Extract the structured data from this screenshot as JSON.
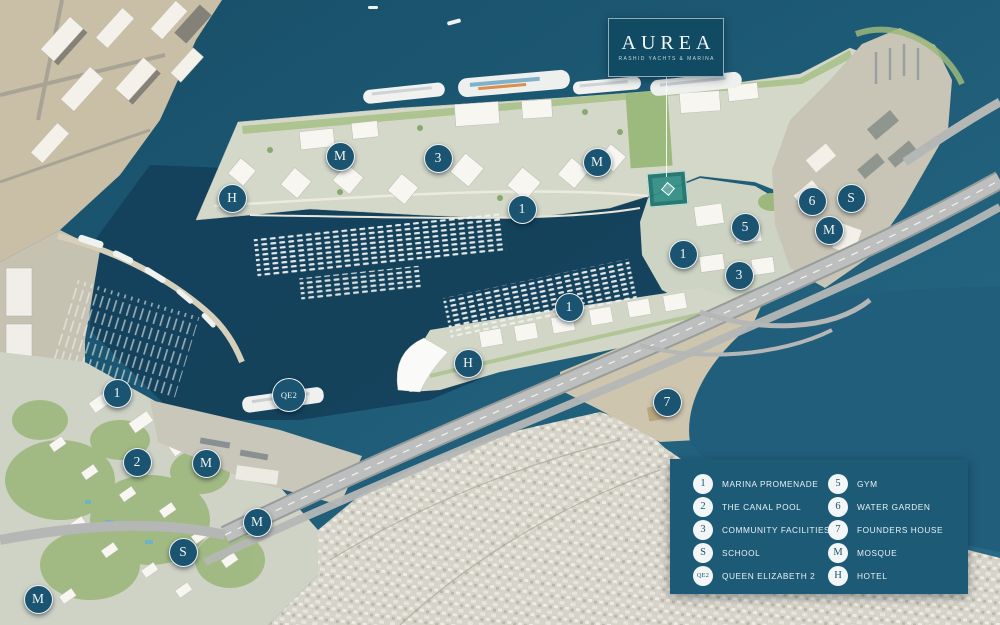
{
  "brand": {
    "title": "AUREA",
    "subtitle": "RASHID YACHTS & MARINA"
  },
  "legend": {
    "left": [
      {
        "id": "1",
        "label": "MARINA PROMENADE"
      },
      {
        "id": "2",
        "label": "THE CANAL POOL"
      },
      {
        "id": "3",
        "label": "COMMUNITY FACILITIES"
      },
      {
        "id": "S",
        "label": "SCHOOL"
      },
      {
        "id": "QE2",
        "label": "QUEEN ELIZABETH 2"
      }
    ],
    "right": [
      {
        "id": "5",
        "label": "GYM"
      },
      {
        "id": "6",
        "label": "WATER GARDEN"
      },
      {
        "id": "7",
        "label": "FOUNDERS HOUSE"
      },
      {
        "id": "M",
        "label": "MOSQUE"
      },
      {
        "id": "H",
        "label": "HOTEL"
      }
    ]
  },
  "markers": [
    {
      "label": "M",
      "x": 340,
      "y": 156
    },
    {
      "label": "3",
      "x": 438,
      "y": 158
    },
    {
      "label": "M",
      "x": 597,
      "y": 162
    },
    {
      "label": "H",
      "x": 232,
      "y": 198
    },
    {
      "label": "1",
      "x": 522,
      "y": 209
    },
    {
      "label": "6",
      "x": 812,
      "y": 201
    },
    {
      "label": "S",
      "x": 851,
      "y": 198
    },
    {
      "label": "5",
      "x": 745,
      "y": 227
    },
    {
      "label": "M",
      "x": 829,
      "y": 230
    },
    {
      "label": "1",
      "x": 683,
      "y": 254
    },
    {
      "label": "3",
      "x": 739,
      "y": 275
    },
    {
      "label": "1",
      "x": 569,
      "y": 307
    },
    {
      "label": "H",
      "x": 468,
      "y": 363
    },
    {
      "label": "QE2",
      "x": 289,
      "y": 395
    },
    {
      "label": "1",
      "x": 117,
      "y": 393
    },
    {
      "label": "7",
      "x": 667,
      "y": 402
    },
    {
      "label": "2",
      "x": 137,
      "y": 462
    },
    {
      "label": "M",
      "x": 206,
      "y": 463
    },
    {
      "label": "M",
      "x": 257,
      "y": 522
    },
    {
      "label": "S",
      "x": 183,
      "y": 552
    },
    {
      "label": "M",
      "x": 38,
      "y": 599
    }
  ],
  "colors": {
    "marker_bg": "#1a5470",
    "legend_bg": "#1d5a76",
    "highlight_plot": "#2f8d84",
    "water_deep": "#184e68",
    "water_light": "#2a6c88"
  }
}
